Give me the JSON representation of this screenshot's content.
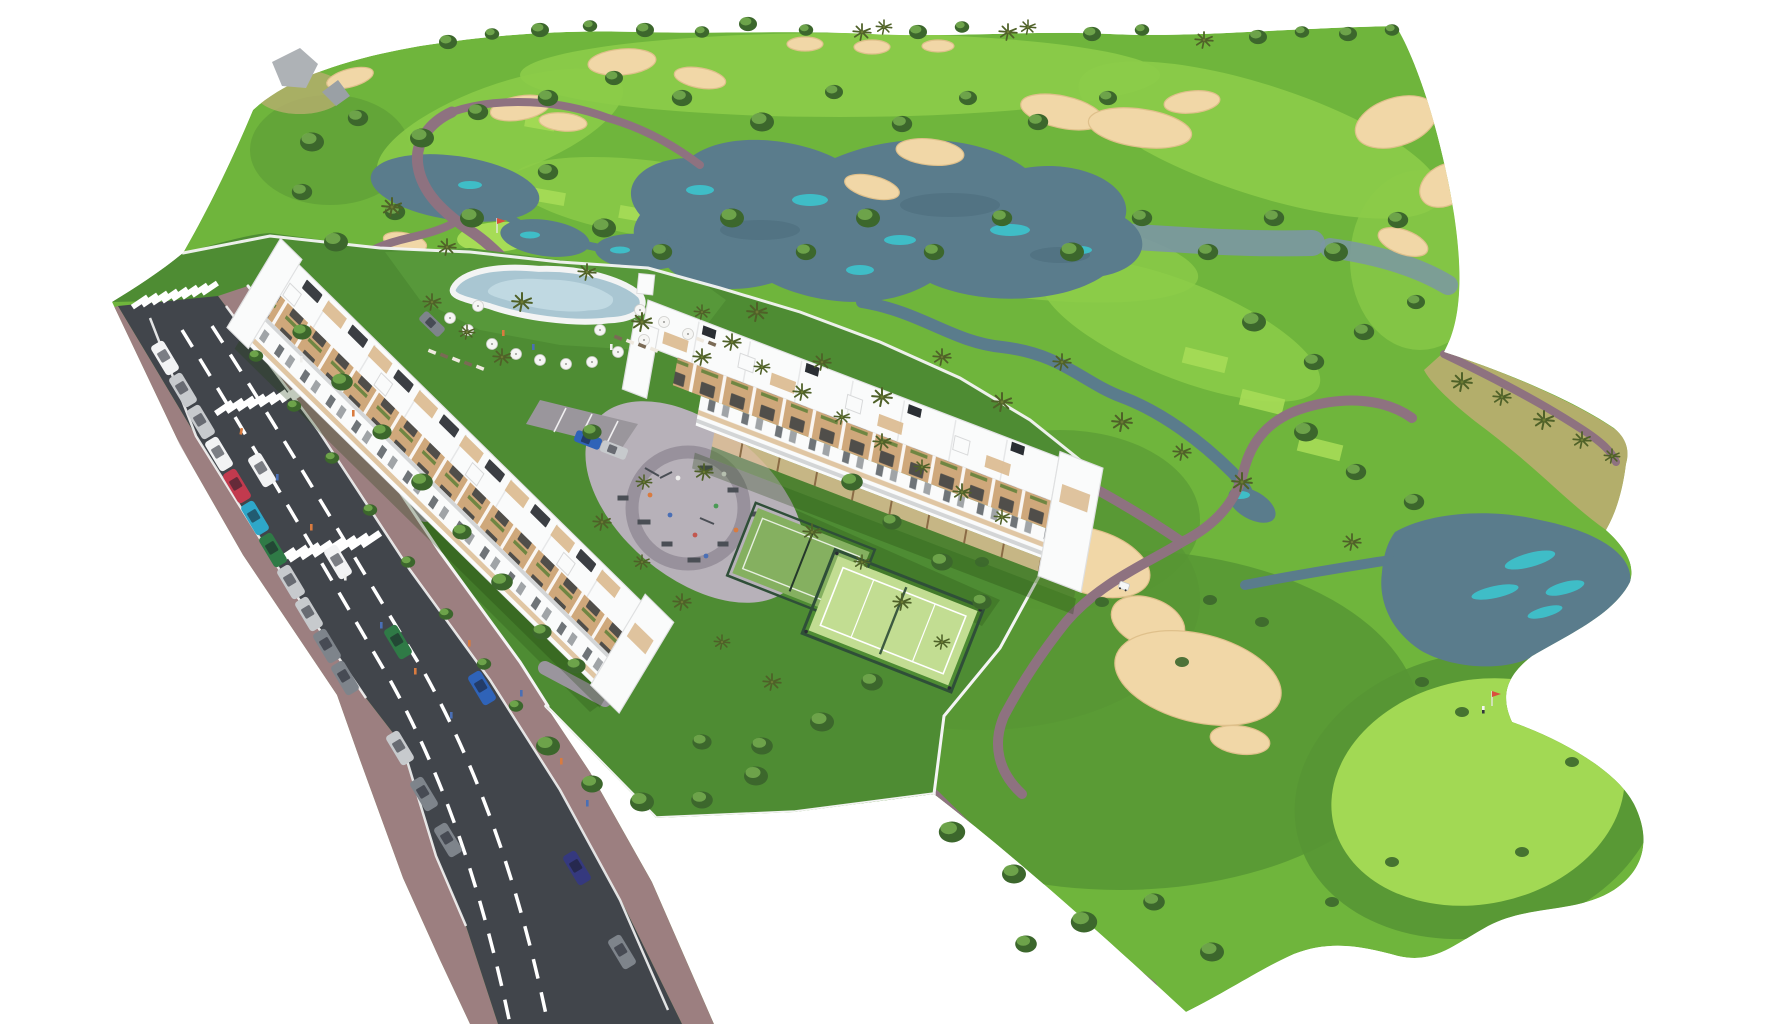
{
  "scene": {
    "description": "Aerial 3D architectural rendering of a golf resort residential development: two white terraced apartment blocks with tan balconies around a playground plaza, lagoon swimming pool with umbrellas, two fenced padel courts, perimeter gardens with palm trees, a two-lane road with parked and moving cars, zebra crossings and brick sidewalks, surrounded by a golf course with lakes, streams, sand bunkers, putting greens with flags, cart paths, a golf cart and tree-lined horizon on a white background",
    "setting": "golf-course residential masterplan, isometric aerial view"
  },
  "inventory": {
    "apartment_blocks": 2,
    "swimming_pools": 1,
    "padel_courts": 2,
    "playgrounds": 1,
    "road_lanes": 2,
    "crosswalks": 3,
    "parked_cars": 14,
    "moving_cars": 6,
    "cars_inside_site": 3,
    "golf_carts": 1,
    "golf_flags": 2,
    "golfers": 1,
    "lakes_and_ponds": 6,
    "streams": 3,
    "sand_bunkers": 20,
    "tee_boxes": 6,
    "putting_greens": 2,
    "pool_umbrellas": 14,
    "palm_trees": 45,
    "round_trees": 78
  },
  "colors": {
    "bg": "#ffffff",
    "grass_base": "#6fb53c",
    "grass_light": "#8ccc49",
    "grass_bright": "#a6dc56",
    "grass_dark": "#4e8c33",
    "grass_site": "#57983a",
    "rough": "#579634",
    "scrub": "#b6ae6e",
    "lake": "#5a7c8c",
    "lake_deep": "#4a6a7a",
    "lake_pale": "#7b97a3",
    "lake_teal": "#3ac9d2",
    "sand": "#f1d7a7",
    "sand_shadow": "#dfc08b",
    "path": "#8e7280",
    "road": "#41454b",
    "road_line": "#ffffff",
    "sidewalk": "#9c7f80",
    "curb": "#e8e8e8",
    "wall": "#f4f4f4",
    "bldg": "#fafbfb",
    "bldg_shade": "#dcdddf",
    "balcony": "#cfa87b",
    "balcony_light": "#dcbd94",
    "wood": "#8a6b45",
    "win": "#343a40",
    "pergola": "#2a2e33",
    "planter": "#4e7a2f",
    "pool": "#a9c6d2",
    "pool_light": "#c6dde6",
    "deck": "#f3f4f4",
    "court_light": "#c2dd92",
    "court_dark": "#85b060",
    "fence": "#2f4f38",
    "plaza": "#b7b1b9",
    "plaza_ring": "#938c97",
    "gray_lot": "#9a969c",
    "tree_dark": "#3c672c",
    "tree_mid": "#548f38",
    "tree_light": "#79b353",
    "palm": "#4f6128",
    "trunk": "#8a7355",
    "rock": "#aeb2b6",
    "shadow": "#22400f",
    "car_white": "#f2f3f4",
    "car_silver": "#c7cacd",
    "car_gray": "#7e848b",
    "car_red": "#c23a4e",
    "car_blue": "#2f63b8",
    "car_teal": "#2ea7c9",
    "car_green": "#2f7a46",
    "car_navy": "#35397e",
    "ppl_orange": "#d97b3f",
    "ppl_blue": "#4a6fb5",
    "flag_red": "#d94f3d"
  }
}
